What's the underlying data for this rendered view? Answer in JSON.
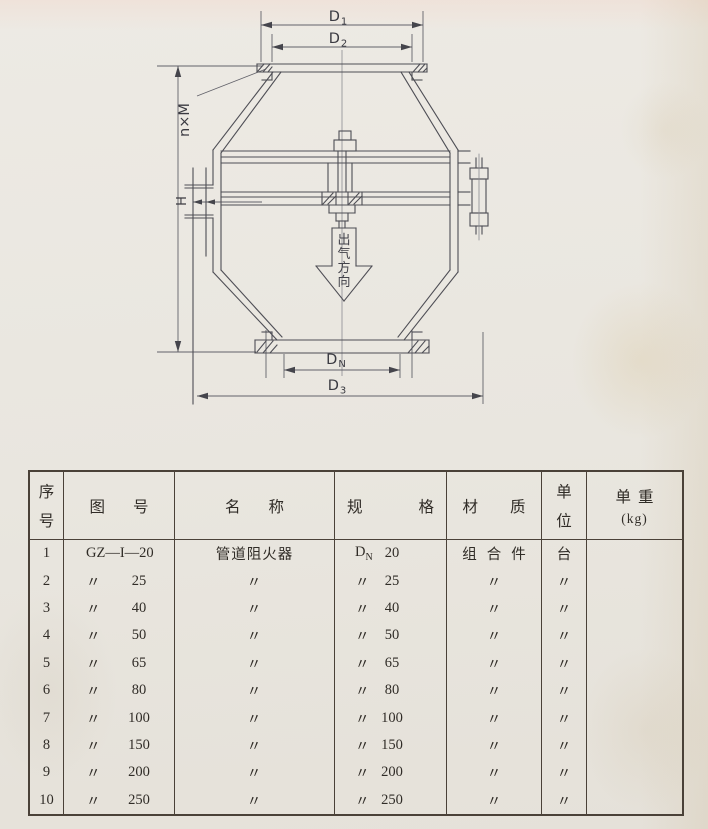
{
  "drawing": {
    "d1": {
      "main": "D",
      "sub": "1"
    },
    "d2": {
      "main": "D",
      "sub": "2"
    },
    "dn": {
      "main": "D",
      "sub": "N"
    },
    "d3": {
      "main": "D",
      "sub": "3"
    },
    "bolts_label": "n×M",
    "h_label": "H",
    "arrow_text": "出气方向"
  },
  "table": {
    "headers": {
      "seq_a": "序",
      "seq_b": "号",
      "fig_a": "图",
      "fig_b": "号",
      "name_a": "名",
      "name_b": "称",
      "spec_a": "规",
      "spec_b": "格",
      "mat_a": "材",
      "mat_b": "质",
      "unit_a": "单",
      "unit_b": "位",
      "wt_a": "单重",
      "wt_b": "(kg)"
    },
    "spec_d": {
      "main": "D",
      "sub": "N"
    },
    "rows": [
      {
        "seq": "1",
        "fig": "GZ—I—20",
        "name": "管道阻火器",
        "spec_num": "20",
        "mat": "组合件",
        "unit": "台"
      },
      {
        "seq": "2",
        "fig": "〃",
        "fig_num": "25",
        "name": "〃",
        "spec": "〃",
        "spec_num": "25",
        "mat": "〃",
        "unit": "〃"
      },
      {
        "seq": "3",
        "fig": "〃",
        "fig_num": "40",
        "name": "〃",
        "spec": "〃",
        "spec_num": "40",
        "mat": "〃",
        "unit": "〃"
      },
      {
        "seq": "4",
        "fig": "〃",
        "fig_num": "50",
        "name": "〃",
        "spec": "〃",
        "spec_num": "50",
        "mat": "〃",
        "unit": "〃"
      },
      {
        "seq": "5",
        "fig": "〃",
        "fig_num": "65",
        "name": "〃",
        "spec": "〃",
        "spec_num": "65",
        "mat": "〃",
        "unit": "〃"
      },
      {
        "seq": "6",
        "fig": "〃",
        "fig_num": "80",
        "name": "〃",
        "spec": "〃",
        "spec_num": "80",
        "mat": "〃",
        "unit": "〃"
      },
      {
        "seq": "7",
        "fig": "〃",
        "fig_num": "100",
        "name": "〃",
        "spec": "〃",
        "spec_num": "100",
        "mat": "〃",
        "unit": "〃"
      },
      {
        "seq": "8",
        "fig": "〃",
        "fig_num": "150",
        "name": "〃",
        "spec": "〃",
        "spec_num": "150",
        "mat": "〃",
        "unit": "〃"
      },
      {
        "seq": "9",
        "fig": "〃",
        "fig_num": "200",
        "name": "〃",
        "spec": "〃",
        "spec_num": "200",
        "mat": "〃",
        "unit": "〃"
      },
      {
        "seq": "10",
        "fig": "〃",
        "fig_num": "250",
        "name": "〃",
        "spec": "〃",
        "spec_num": "250",
        "mat": "〃",
        "unit": "〃"
      }
    ]
  }
}
